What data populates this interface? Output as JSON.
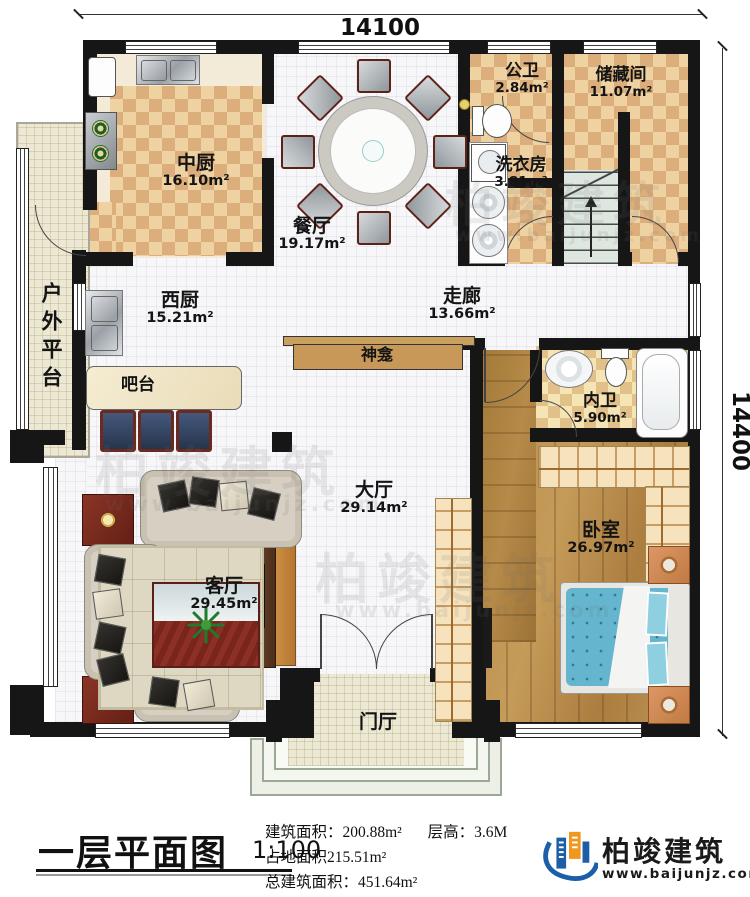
{
  "dimensions": {
    "top": "14100",
    "right": "14400"
  },
  "rooms": [
    {
      "name": "中厨",
      "area": "16.10m²"
    },
    {
      "name": "餐厅",
      "area": "19.17m²"
    },
    {
      "name": "公卫",
      "area": "2.84m²"
    },
    {
      "name": "储藏间",
      "area": "11.07m²"
    },
    {
      "name": "洗衣房",
      "area": "3.81m²"
    },
    {
      "name": "西厨",
      "area": "15.21m²"
    },
    {
      "name": "走廊",
      "area": "13.66m²"
    },
    {
      "name": "神龛",
      "area": ""
    },
    {
      "name": "内卫",
      "area": "5.90m²"
    },
    {
      "name": "吧台",
      "area": ""
    },
    {
      "name": "户外平台",
      "area": ""
    },
    {
      "name": "大厅",
      "area": "29.14m²"
    },
    {
      "name": "卧室",
      "area": "26.97m²"
    },
    {
      "name": "客厅",
      "area": "29.45m²"
    },
    {
      "name": "门厅",
      "area": ""
    }
  ],
  "title_block": {
    "plan_title": "一层平面图",
    "scale": "1:100",
    "stat_line1a": "建筑面积：200.88m²",
    "stat_line1b": "层高：3.6M",
    "stat_line2": "占地面积215.51m²",
    "stat_line3": "总建筑面积：451.64m²",
    "brand_name": "柏竣建筑",
    "brand_url": "www.baijunjz.com"
  },
  "watermark": {
    "text": "柏竣建筑",
    "url": "www.baijunjz.com"
  },
  "colors": {
    "wall": "#161616",
    "checker_light": "#eed2a2",
    "checker_dark": "#dcae7b",
    "bath_checker_light": "#f5e5b4",
    "bath_checker_dark": "#e2c089",
    "wood": "#b98e4e",
    "bed_blue": "#66b5ce",
    "brand_blue": "#1c5fa8",
    "brand_orange": "#f0971e"
  }
}
